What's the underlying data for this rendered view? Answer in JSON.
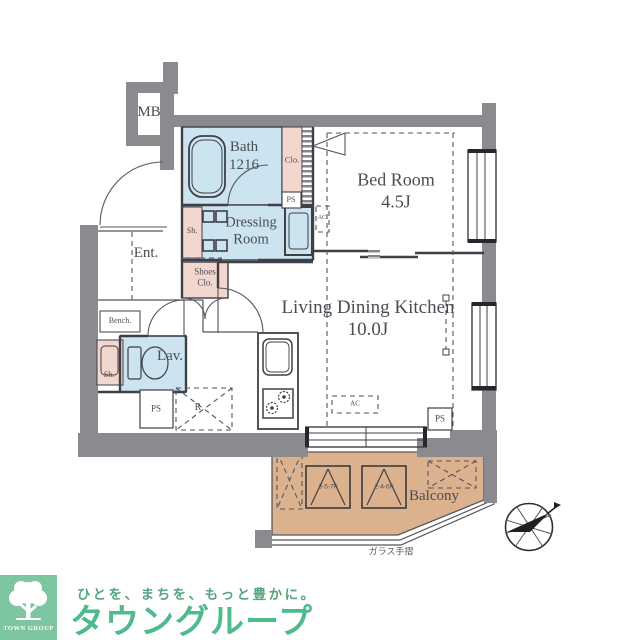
{
  "plan": {
    "mb": "MB",
    "bath": {
      "name": "Bath",
      "size": "1216"
    },
    "closet": "Clo.",
    "ps": "PS",
    "sh": "Sh.",
    "bedroom": {
      "name": "Bed Room",
      "size": "4.5J"
    },
    "dressing": {
      "line1": "Dressing",
      "line2": "Room"
    },
    "entrance": "Ent.",
    "shoes_closet": {
      "line1": "Shoes",
      "line2": "Clo."
    },
    "bench": "Bench.",
    "lavatory": "Lav.",
    "refrigerator": "R",
    "ldk": {
      "name": "Living Dining Kitchen",
      "size": "10.0J"
    },
    "ac": "AC",
    "balcony": "Balcony",
    "evac_hatch_1": "3-5-7F",
    "evac_hatch_2": "2-4-6F",
    "glass_rail": "ガラス手摺"
  },
  "branding": {
    "logo_block": "TOWN GROUP",
    "tagline": "ひとを、まちを、もっと豊かに。",
    "company": "タウングループ"
  },
  "colors": {
    "wall": "#8A8A8F",
    "line": "#3F3F46",
    "ink": "#4C4C54",
    "room_blue": "#CBE4EF",
    "room_blue_light": "#E2F1F7",
    "room_pink": "#F2D7CE",
    "balcony_tan": "#DCB18D",
    "logo_green": "#7EC6A1",
    "brand_green": "#4FBA8C",
    "tagline_green": "#55A57E"
  }
}
